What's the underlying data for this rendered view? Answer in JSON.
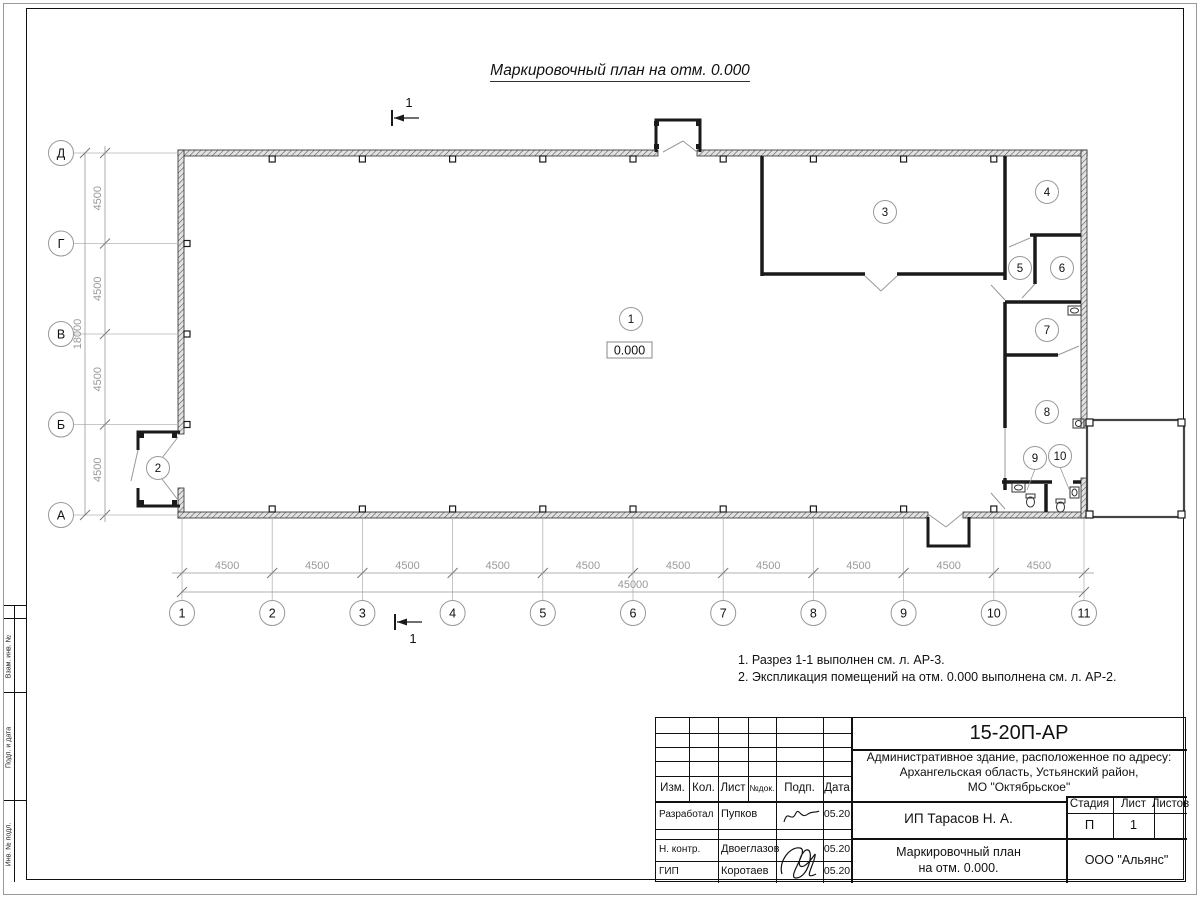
{
  "page": {
    "title": "Маркировочный план на отм. 0.000",
    "notes": [
      "1. Разрез 1-1 выполнен см. л. АР-3.",
      "2. Экспликация помещений на отм. 0.000 выполнена см. л. АР-2."
    ]
  },
  "plan": {
    "elevation_label": "0.000",
    "section_mark": "1",
    "room_numbers": [
      "1",
      "2",
      "3",
      "4",
      "5",
      "6",
      "7",
      "8",
      "9",
      "10"
    ],
    "axes_horizontal": [
      "1",
      "2",
      "3",
      "4",
      "5",
      "6",
      "7",
      "8",
      "9",
      "10",
      "11"
    ],
    "axes_vertical": [
      "Д",
      "Г",
      "В",
      "Б",
      "А"
    ],
    "dim_horizontal_segments": [
      "4500",
      "4500",
      "4500",
      "4500",
      "4500",
      "4500",
      "4500",
      "4500",
      "4500",
      "4500"
    ],
    "dim_horizontal_total": "45000",
    "dim_vertical_segments": [
      "4500",
      "4500",
      "4500",
      "4500"
    ],
    "dim_vertical_total": "18000"
  },
  "frame": {
    "side_labels": [
      "Взам. инв. №",
      "Подп. и дата",
      "Инв. № подл."
    ]
  },
  "title_block": {
    "code": "15-20П-АР",
    "object_lines": [
      "Административное здание, расположенное по адресу:",
      "Архангельская область, Устьянский район,",
      "МО \"Октябрьское\""
    ],
    "columns": [
      "Изм.",
      "Кол.",
      "Лист",
      "№док.",
      "Подп.",
      "Дата"
    ],
    "rows": [
      {
        "role": "Разработал",
        "name": "Пупков",
        "date": "05.20"
      },
      {
        "role": "Н. контр.",
        "name": "Двоеглазов",
        "date": "05.20"
      },
      {
        "role": "ГИП",
        "name": "Коротаев",
        "date": "05.20"
      }
    ],
    "client": "ИП Тарасов Н. А.",
    "sheet_title_lines": [
      "Маркировочный план",
      "на отм. 0.000."
    ],
    "stage_header": [
      "Стадия",
      "Лист",
      "Листов"
    ],
    "stage": "П",
    "sheet_number": "1",
    "organization": "ООО \"Альянс\""
  }
}
